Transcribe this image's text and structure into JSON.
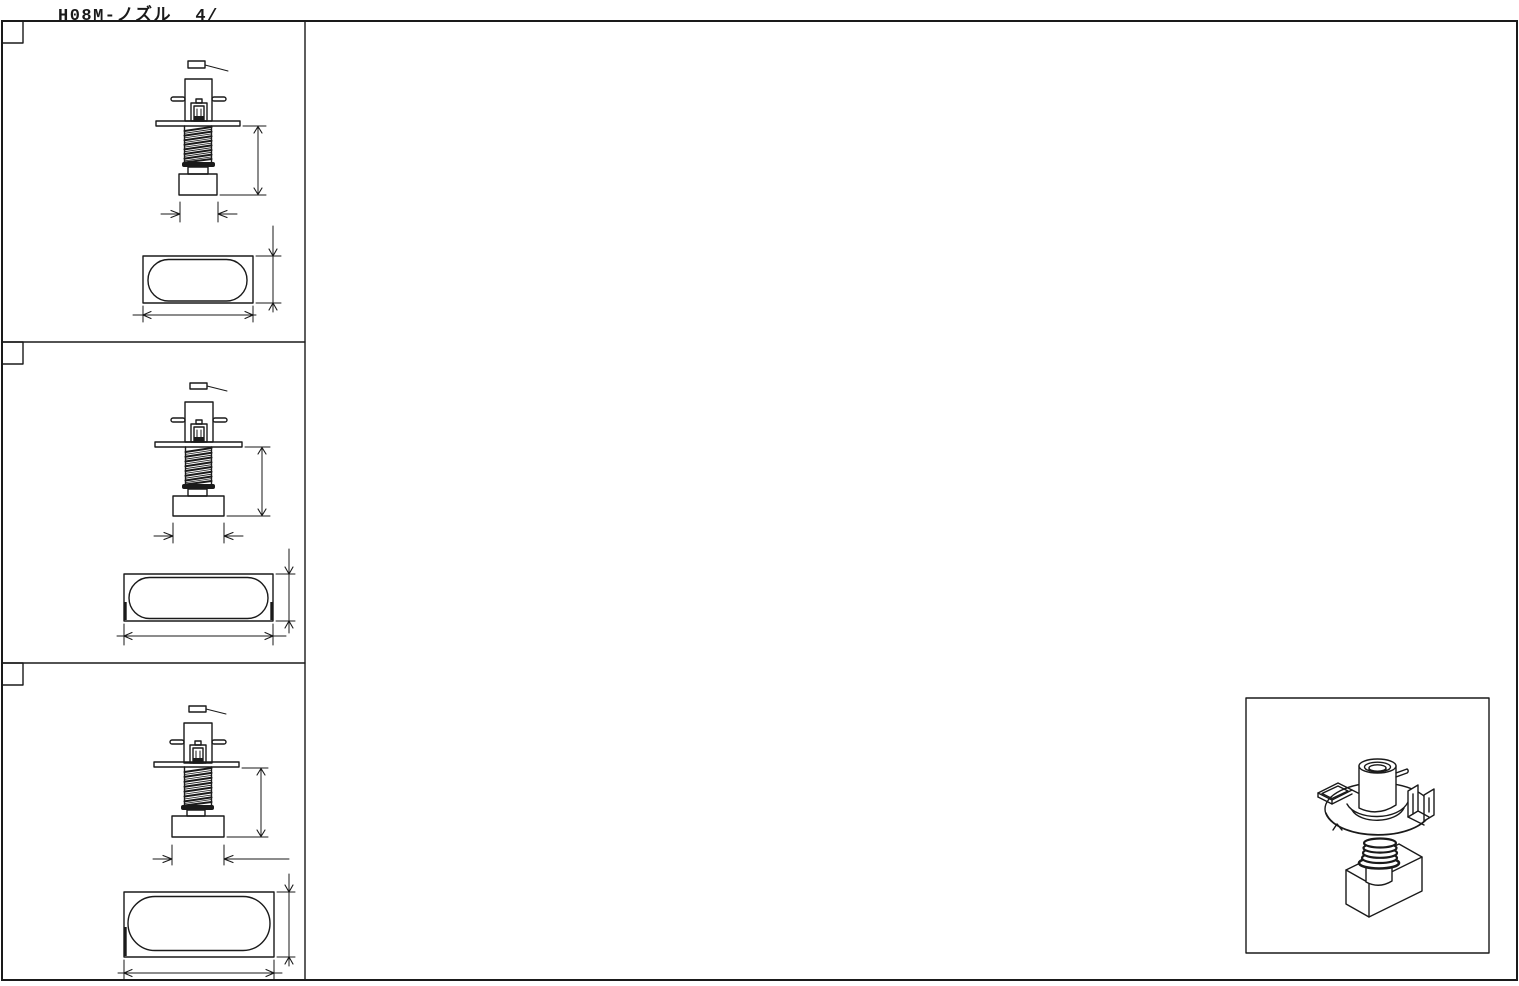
{
  "title": "H08M-ノズル  4/",
  "colors": {
    "line": "#1a1a1a",
    "background": "#ffffff"
  }
}
